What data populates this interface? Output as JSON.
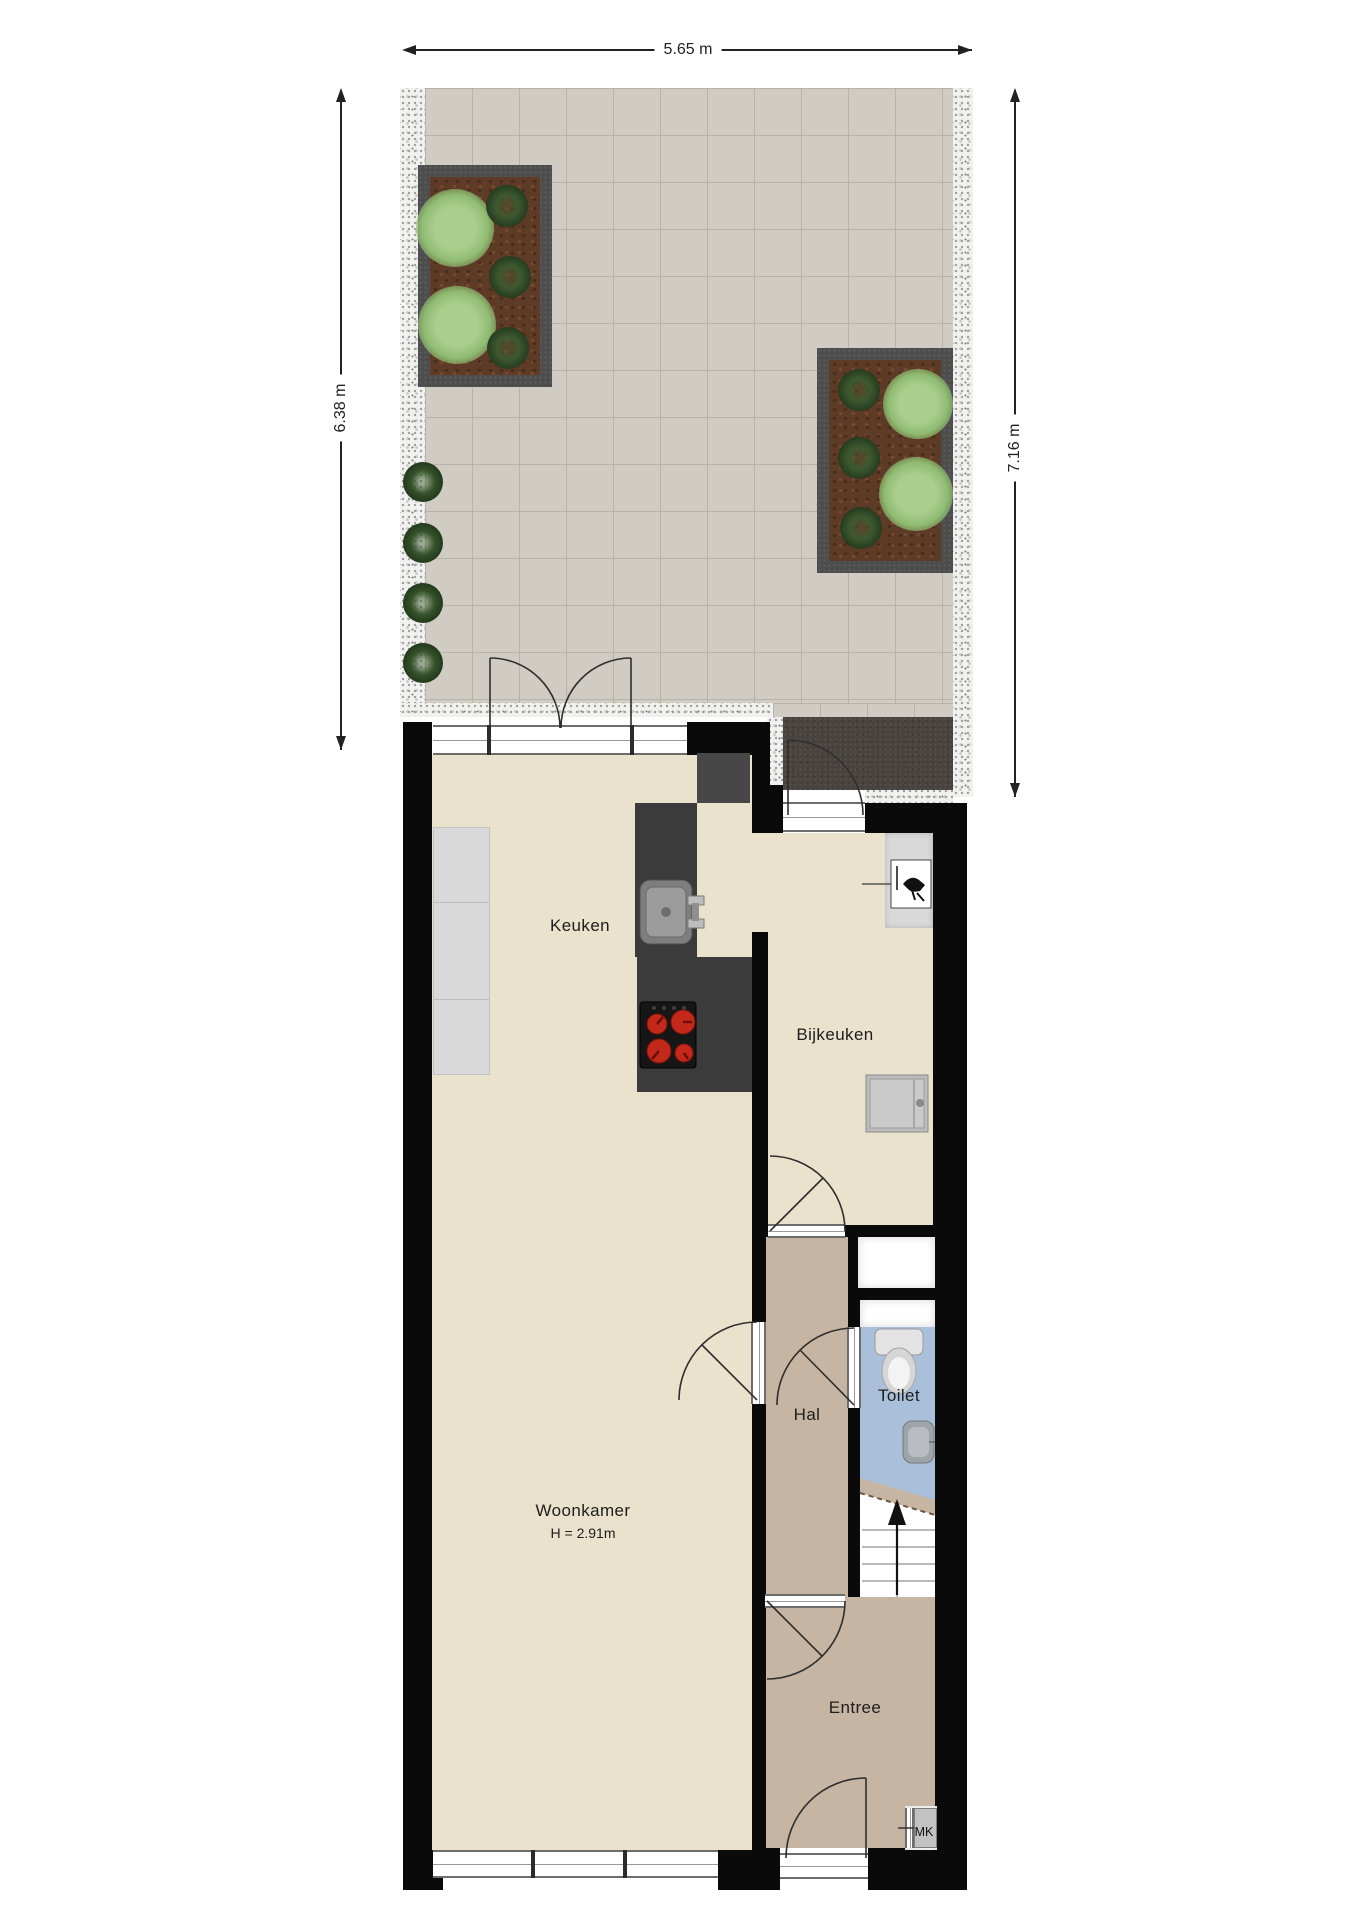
{
  "dimensions": {
    "top": "5.65 m",
    "left": "6.38 m",
    "right": "7.16 m"
  },
  "rooms": {
    "keuken": {
      "label": "Keuken"
    },
    "bijkeuken": {
      "label": "Bijkeuken"
    },
    "hal": {
      "label": "Hal"
    },
    "toilet": {
      "label": "Toilet"
    },
    "woonkamer": {
      "label": "Woonkamer",
      "note": "H = 2.91m"
    },
    "entree": {
      "label": "Entree"
    },
    "meterkast": {
      "label": "MK"
    }
  },
  "colors": {
    "wall": "#0a0a0a",
    "floor_living": "#eae2cc",
    "floor_hall": "#c7b5a3",
    "floor_toilet": "#aabfda",
    "garden_tile": "#d1ccc3",
    "gravel": "#f1f1f0",
    "path": "#48433f",
    "planter": "#4d4d4d",
    "soil": "#5e3b26",
    "counter_dark": "#3b3b3b",
    "counter_light": "#d9d9d9",
    "burner": "#c2291a",
    "label": "#1d1d1d"
  }
}
